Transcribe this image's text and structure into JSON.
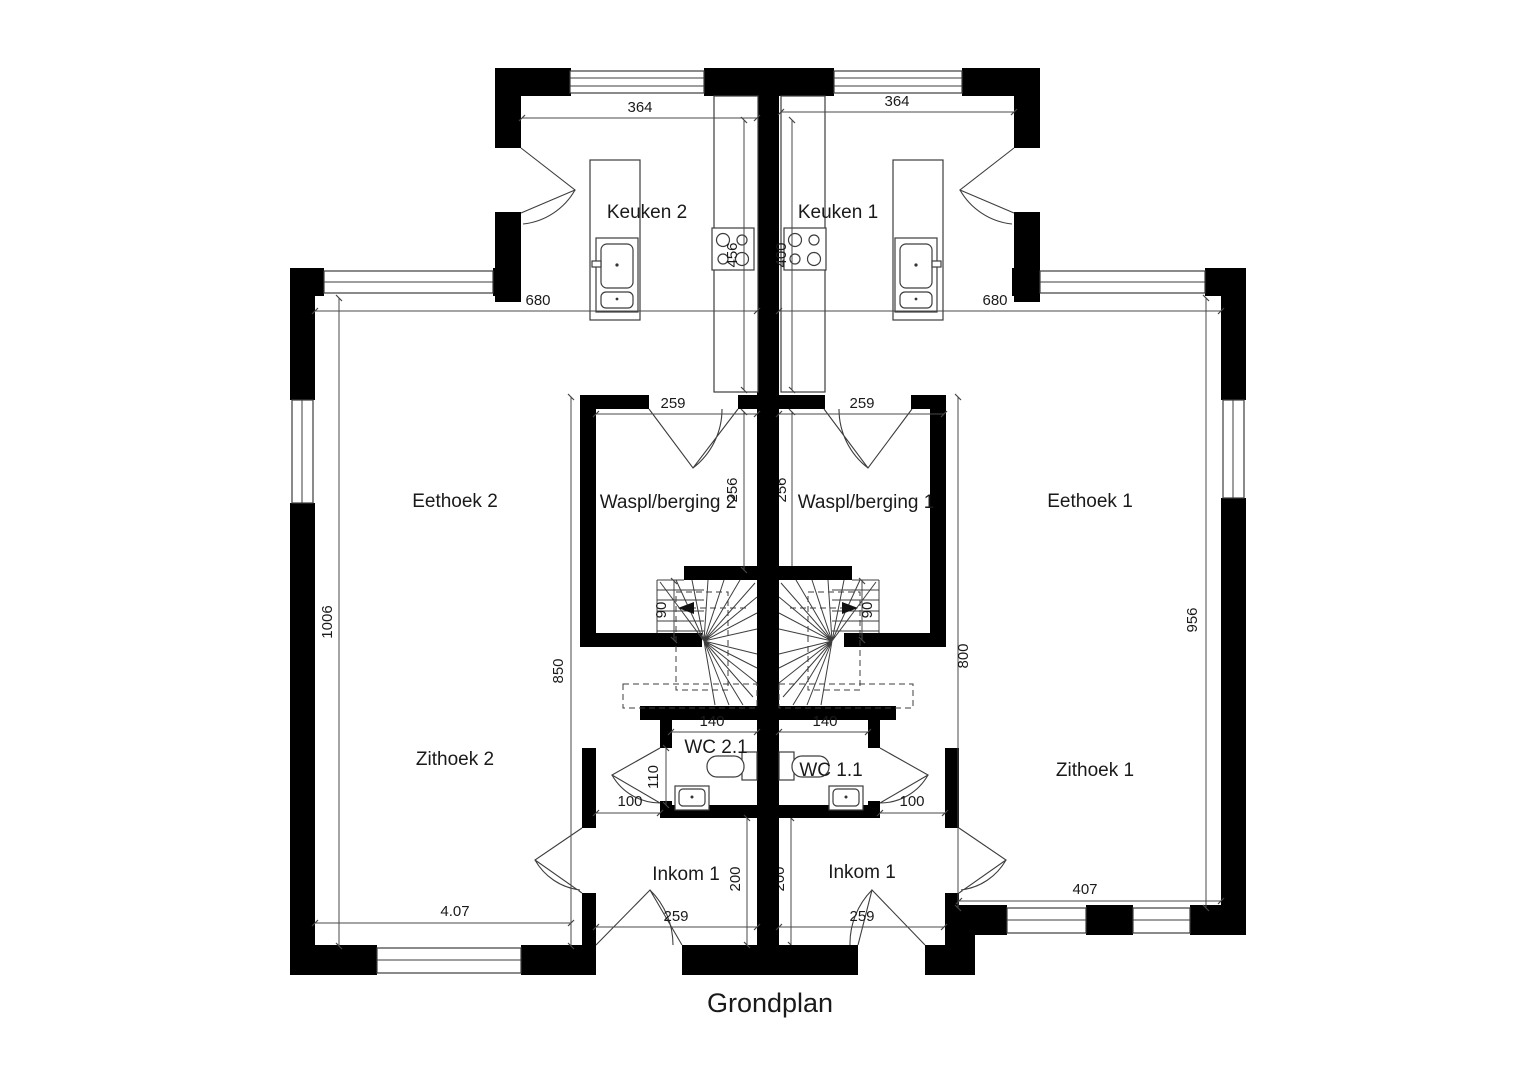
{
  "title": "Grondplan",
  "rooms": {
    "keuken2": "Keuken 2",
    "keuken1": "Keuken 1",
    "eethoek2": "Eethoek 2",
    "eethoek1": "Eethoek 1",
    "waspl2": "Waspl/berging 2",
    "waspl1": "Waspl/berging 1",
    "zithoek2": "Zithoek 2",
    "zithoek1": "Zithoek 1",
    "wc2": "WC 2.1",
    "wc1": "WC 1.1",
    "inkom2": "Inkom 1",
    "inkom1": "Inkom 1"
  },
  "dims": {
    "kitchen2_width": "364",
    "kitchen1_width": "364",
    "living2_width": "680",
    "living1_width": "680",
    "counter2_depth": "456",
    "counter1_depth": "400",
    "berging2_door": "259",
    "berging1_door": "259",
    "berging2_depth": "256",
    "berging1_depth": "256",
    "wall_left_height": "1006",
    "inner_left_height": "850",
    "inner_right_height": "800",
    "wall_right_height": "956",
    "stair2_width": "90",
    "stair1_width": "90",
    "wc2_width": "140",
    "wc1_width": "140",
    "wc2_depth": "110",
    "hall2_width": "100",
    "hall1_width": "100",
    "inkom2_depth": "200",
    "inkom1_depth": "200",
    "inkom2_door": "259",
    "inkom1_door": "259",
    "zithoek2_width": "4.07",
    "zithoek1_width": "407"
  },
  "colors": {
    "wall": "#000000",
    "line": "#3d3d3d",
    "dim": "#4a4a4a",
    "text": "#1a1a1a",
    "bg": "#ffffff"
  }
}
